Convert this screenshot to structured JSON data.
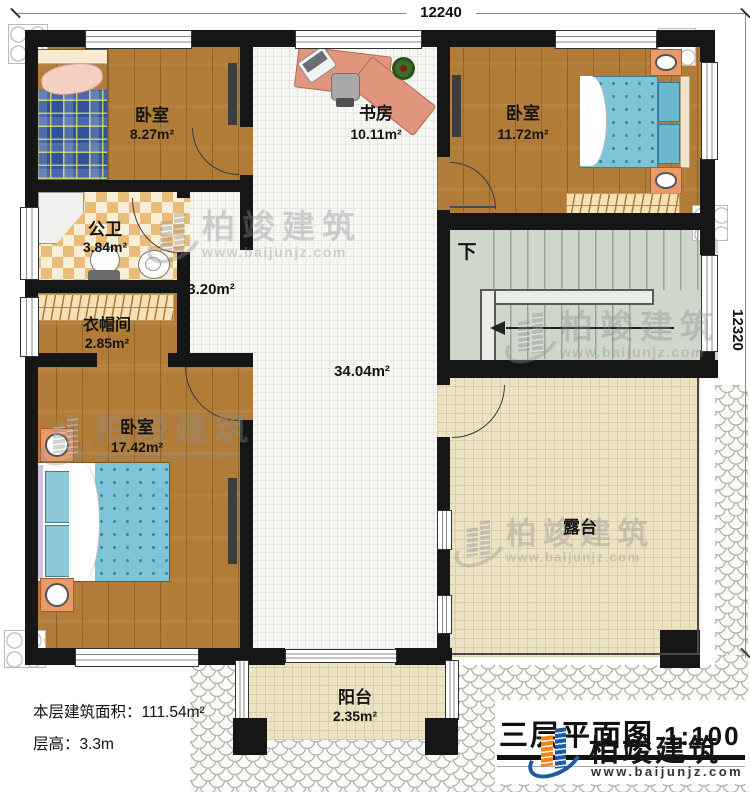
{
  "plan": {
    "dimensions": {
      "top": "12240",
      "right": "12320"
    },
    "rooms": [
      {
        "name": "卧室",
        "area": "8.27m²"
      },
      {
        "name": "书房",
        "area": "10.11m²"
      },
      {
        "name": "卧室",
        "area": "11.72m²"
      },
      {
        "name": "公卫",
        "area": "3.84m²"
      },
      {
        "name": "衣帽间",
        "area": "2.85m²"
      },
      {
        "name": "卧室",
        "area": "17.42m²"
      },
      {
        "name": "露台"
      },
      {
        "name": "阳台",
        "area": "2.35m²"
      }
    ],
    "open_areas": {
      "corridor": "3.20m²",
      "hall": "34.04m²"
    },
    "stairs": {
      "direction_label": "下"
    },
    "info": {
      "area_line": "本层建筑面积：111.54m²",
      "height_line": "层高：3.3m"
    },
    "title": {
      "text": "三层平面图",
      "scale": "1:100"
    },
    "branding": {
      "company": "柏竣建筑",
      "website": "www.baijunjz.com"
    }
  }
}
